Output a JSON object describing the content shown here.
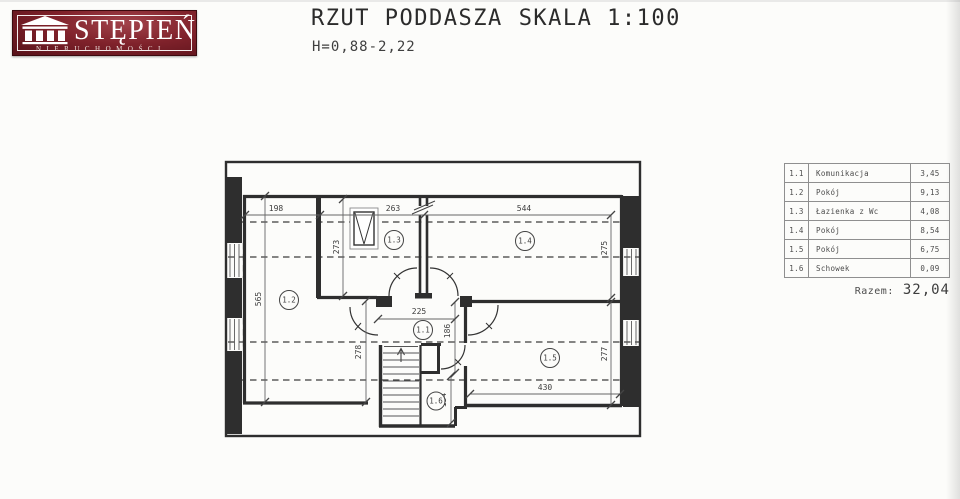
{
  "logo": {
    "name": "STĘPIEŃ",
    "tagline": "NIERUCHOMOŚCI"
  },
  "header": {
    "title": "RZUT PODDASZA",
    "scale": "SKALA 1:100",
    "heights": "H=0,88-2,22"
  },
  "legend": {
    "rows": [
      {
        "no": "1.1",
        "name": "Komunikacja",
        "area": "3,45"
      },
      {
        "no": "1.2",
        "name": "Pokój",
        "area": "9,13"
      },
      {
        "no": "1.3",
        "name": "Łazienka z Wc",
        "area": "4,08"
      },
      {
        "no": "1.4",
        "name": "Pokój",
        "area": "8,54"
      },
      {
        "no": "1.5",
        "name": "Pokój",
        "area": "6,75"
      },
      {
        "no": "1.6",
        "name": "Schowek",
        "area": "0,09"
      }
    ],
    "total_label": "Razem:",
    "total_value": "32,04"
  },
  "plan": {
    "room_labels": [
      "1.1",
      "1.2",
      "1.3",
      "1.4",
      "1.5",
      "1.6"
    ],
    "dims": {
      "w12": "198",
      "w13": "263",
      "w14": "544",
      "h12": "565",
      "h13": "273",
      "h14": "275",
      "hall_w": "225",
      "hall_h": "186",
      "h12b": "278",
      "h15": "277",
      "w15": "430",
      "h16": "134"
    }
  },
  "colors": {
    "logo_red": "#7c2029",
    "line": "#2e2e2e",
    "dim_line": "#666666"
  }
}
